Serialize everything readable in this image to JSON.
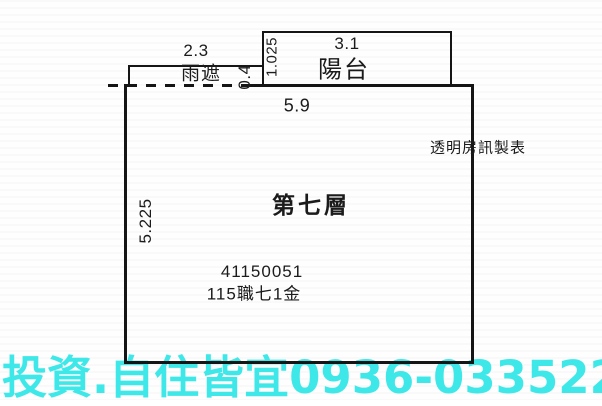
{
  "plan": {
    "floor_label": "第七層",
    "credit": "透明房訊製表",
    "registration_no": "41150051",
    "registration_ref": "115職七1金",
    "main_room": {
      "width_m": "5.9",
      "depth_m": "5.225"
    },
    "balcony": {
      "label": "陽台",
      "width_m": "3.1",
      "depth_m": "1.025"
    },
    "rain_cover": {
      "label": "雨遮",
      "width_m": "2.3",
      "depth_m": "0.4"
    }
  },
  "watermark": {
    "text": "投資.自住皆宜0936-033522",
    "color": "#3fe8e8"
  },
  "colors": {
    "line": "#151515",
    "text": "#1b1b1b",
    "paper": "#fefefe"
  }
}
